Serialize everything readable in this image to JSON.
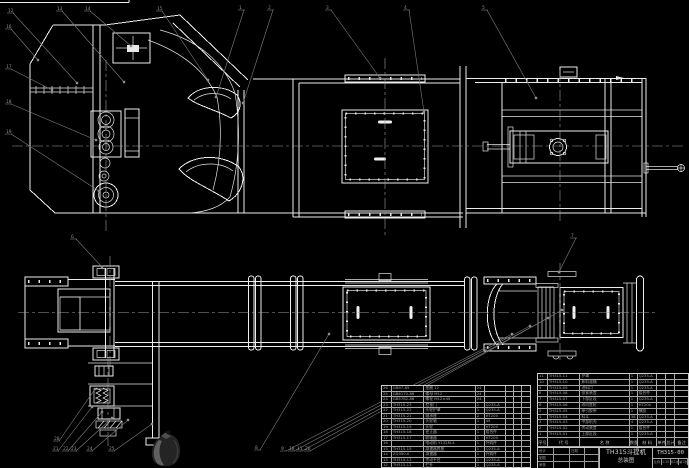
{
  "title_block": {
    "product": "TH315斗提机",
    "drawing_type": "总装图",
    "drawing_no": "TH315-00",
    "footer_cells": [
      "比例",
      "1:10",
      "共1张",
      "第1张"
    ],
    "signature_grid": [
      [
        "设计",
        "",
        "日期",
        ""
      ],
      [
        "制图",
        "",
        "",
        ""
      ],
      [
        "审核",
        "",
        "",
        ""
      ]
    ]
  },
  "bom": {
    "headers": [
      "序号",
      "代 号",
      "名 称",
      "数量",
      "材 料",
      "单件",
      "总计",
      "备注"
    ],
    "right_rows": [
      [
        "11",
        "TH315-11",
        "护罩",
        "1",
        "Q235-A",
        "",
        "",
        ""
      ],
      [
        "10",
        "TH315-10",
        "卸料溜槽",
        "1",
        "Q235-A",
        "",
        "",
        ""
      ],
      [
        "9",
        "TH315-09",
        "进料口",
        "1",
        "Q235-A",
        "",
        "",
        ""
      ],
      [
        "8",
        "TH315-08",
        "张紧装置",
        "1",
        "组合件",
        "",
        "",
        ""
      ],
      [
        "7",
        "TH315-07",
        "下部区段",
        "1",
        "Q235-A",
        "",
        "",
        ""
      ],
      [
        "6",
        "TH315-06",
        "改向底轮",
        "1",
        "HT200",
        "",
        "",
        ""
      ],
      [
        "5",
        "TH315-05",
        "牵引胶带",
        "1",
        "橡胶",
        "",
        "",
        ""
      ],
      [
        "4",
        "TH315-04",
        "料斗",
        "38",
        "Q235-A",
        "",
        "",
        ""
      ],
      [
        "3",
        "TH315-03",
        "中部机壳",
        "4",
        "Q235-A",
        "",
        "",
        ""
      ],
      [
        "2",
        "TH315-02",
        "传动装置",
        "1",
        "组合件",
        "",
        "",
        ""
      ],
      [
        "1",
        "TH315-01",
        "上部区段",
        "1",
        "Q235-A",
        "",
        "",
        ""
      ]
    ],
    "left_rows": [
      [
        "26",
        "GB97-85",
        "垫圈 12",
        "24",
        "",
        "",
        "",
        ""
      ],
      [
        "25",
        "GB6170-86",
        "螺母 M12",
        "24",
        "",
        "",
        "",
        ""
      ],
      [
        "24",
        "GB5782-86",
        "螺栓 M12×45",
        "24",
        "",
        "",
        "",
        ""
      ],
      [
        "23",
        "TH315-23",
        "检视门",
        "2",
        "Q235-A",
        "",
        "",
        ""
      ],
      [
        "22",
        "TH315-22",
        "头轮护罩",
        "1",
        "Q235-A",
        "",
        "",
        ""
      ],
      [
        "21",
        "TH315-21",
        "轴承座",
        "2",
        "HT200",
        "",
        "",
        ""
      ],
      [
        "20",
        "TH315-20",
        "头轮轴",
        "1",
        "45",
        "",
        "",
        ""
      ],
      [
        "19",
        "TH315-19",
        "头轮",
        "1",
        "HT200",
        "",
        "",
        ""
      ],
      [
        "18",
        "TH315-18",
        "逆止器",
        "1",
        "组合件",
        "",
        "",
        ""
      ],
      [
        "17",
        "TH315-17",
        "联轴器",
        "1",
        "HT200",
        "",
        "",
        ""
      ],
      [
        "16",
        "",
        "电动机 Y132M-4",
        "1",
        "外购件",
        "",
        "",
        ""
      ],
      [
        "15",
        "TH315-15",
        "减速器底座",
        "1",
        "Q235-A",
        "",
        "",
        ""
      ],
      [
        "14",
        "ZQ350-II",
        "减速器",
        "1",
        "外购件",
        "",
        "",
        ""
      ],
      [
        "13",
        "TH315-13",
        "传动平台",
        "1",
        "Q235-A",
        "",
        "",
        ""
      ],
      [
        "12",
        "TH315-12",
        "栏杆",
        "1",
        "Q235-A",
        "",
        "",
        ""
      ]
    ]
  },
  "callouts": [
    {
      "label": "12",
      "x": 8,
      "y": 8,
      "tx": 77,
      "ty": 83
    },
    {
      "label": "13",
      "x": 57,
      "y": 6,
      "tx": 124,
      "ty": 82
    },
    {
      "label": "14",
      "x": 85,
      "y": 6,
      "tx": 131,
      "ty": 46
    },
    {
      "label": "15",
      "x": 157,
      "y": 6,
      "tx": 208,
      "ty": 80
    },
    {
      "label": "1",
      "x": 239,
      "y": 5,
      "tx": 216,
      "ty": 97
    },
    {
      "label": "2",
      "x": 268,
      "y": 5,
      "tx": 243,
      "ty": 103
    },
    {
      "label": "3",
      "x": 326,
      "y": 5,
      "tx": 380,
      "ty": 78
    },
    {
      "label": "4",
      "x": 404,
      "y": 5,
      "tx": 424,
      "ty": 112
    },
    {
      "label": "5",
      "x": 482,
      "y": 5,
      "tx": 536,
      "ty": 98
    },
    {
      "label": "16",
      "x": 6,
      "y": 24,
      "tx": 38,
      "ty": 60
    },
    {
      "label": "17",
      "x": 6,
      "y": 64,
      "tx": 52,
      "ty": 90
    },
    {
      "label": "18",
      "x": 6,
      "y": 99,
      "tx": 96,
      "ty": 140
    },
    {
      "label": "19",
      "x": 6,
      "y": 129,
      "tx": 99,
      "ty": 191
    },
    {
      "label": "6",
      "x": 71,
      "y": 234,
      "tx": 102,
      "ty": 267
    },
    {
      "label": "7",
      "x": 571,
      "y": 233,
      "tx": 559,
      "ty": 272
    },
    {
      "label": "20",
      "x": 54,
      "y": 436,
      "tx": 95,
      "ty": 389
    },
    {
      "label": "21",
      "x": 53,
      "y": 446,
      "tx": 92,
      "ty": 407
    },
    {
      "label": "22",
      "x": 63,
      "y": 446,
      "tx": 102,
      "ty": 412
    },
    {
      "label": "23",
      "x": 71,
      "y": 446,
      "tx": 112,
      "ty": 418
    },
    {
      "label": "24",
      "x": 87,
      "y": 446,
      "tx": 128,
      "ty": 420
    },
    {
      "label": "25",
      "x": 109,
      "y": 446,
      "tx": 152,
      "ty": 424
    },
    {
      "label": "8",
      "x": 255,
      "y": 445,
      "tx": 329,
      "ty": 334
    },
    {
      "label": "9",
      "x": 281,
      "y": 446,
      "tx": 512,
      "ty": 334
    },
    {
      "label": "10",
      "x": 289,
      "y": 446,
      "tx": 530,
      "ty": 326
    },
    {
      "label": "11",
      "x": 297,
      "y": 446,
      "tx": 548,
      "ty": 318
    },
    {
      "label": "26",
      "x": 305,
      "y": 446,
      "tx": 562,
      "ty": 310
    }
  ]
}
